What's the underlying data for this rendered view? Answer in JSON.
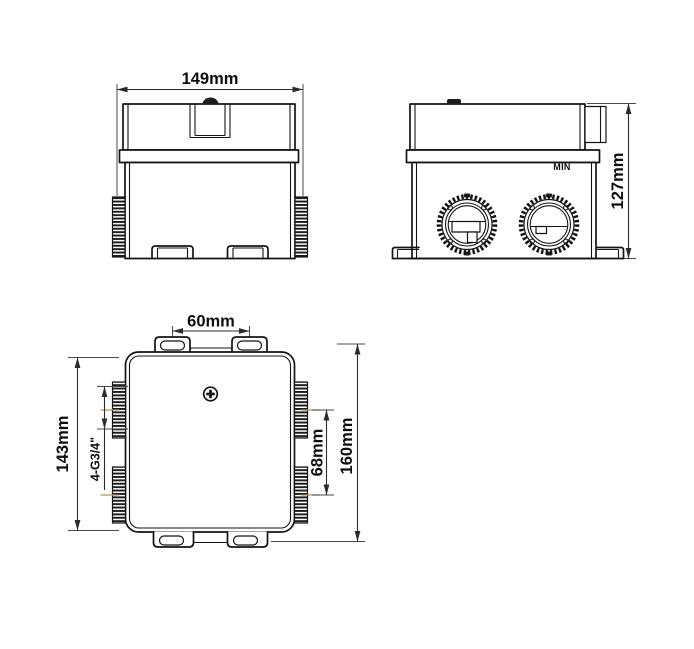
{
  "drawing": {
    "front_view": {
      "width_label": "149mm"
    },
    "side_view": {
      "height_label": "127mm",
      "marking": "MIN"
    },
    "plan_view": {
      "tab_spacing_label": "60mm",
      "body_height_label": "143mm",
      "thread_label": "4-G3/4\"",
      "gland_spacing_label": "68mm",
      "overall_height_label": "160mm"
    }
  },
  "colors": {
    "object_line": "#141414",
    "dimension_line": "#2b2b2b",
    "centerline": "#b3925f",
    "background": "#ffffff"
  }
}
